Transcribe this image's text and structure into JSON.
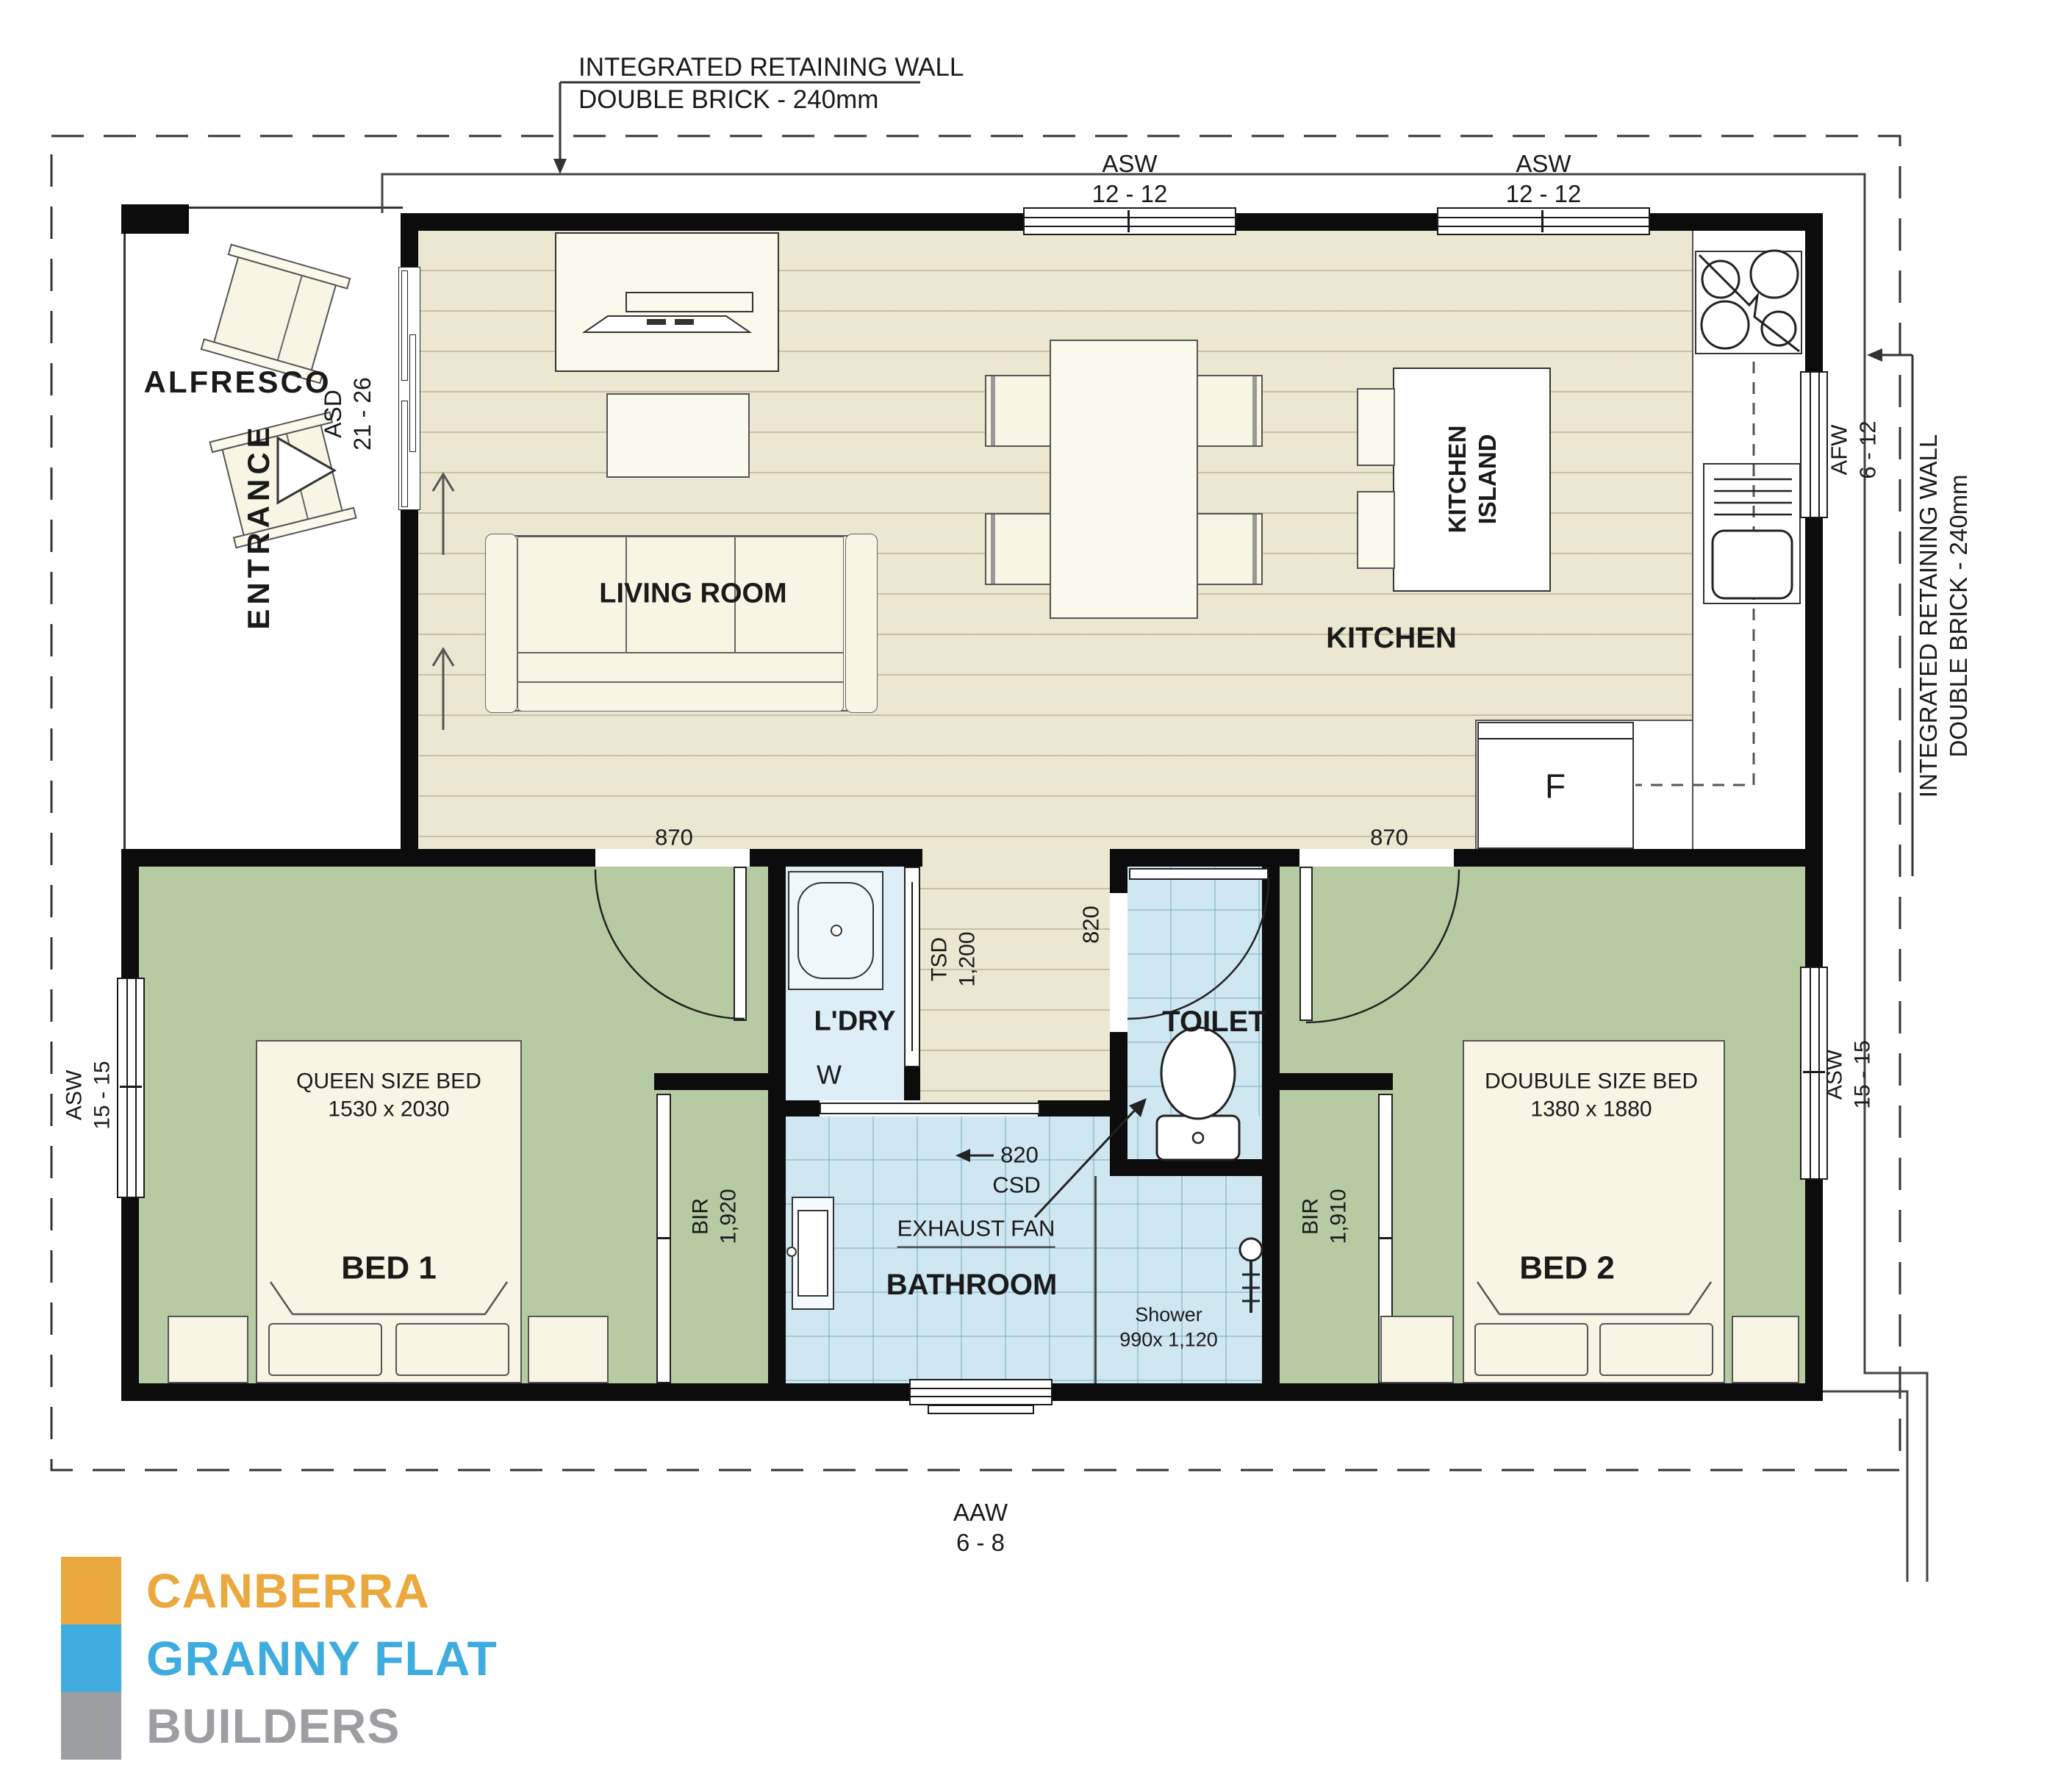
{
  "plan_title": "Granny flat floor plan",
  "annotations": {
    "retaining_top_line1": "INTEGRATED RETAINING WALL",
    "retaining_top_line2": "DOUBLE BRICK - 240mm",
    "retaining_right_line1": "INTEGRATED RETAINING WALL",
    "retaining_right_line2": "DOUBLE BRICK - 240mm"
  },
  "openings": {
    "asw_top1_code": "ASW",
    "asw_top1_size": "12 - 12",
    "asw_top2_code": "ASW",
    "asw_top2_size": "12 - 12",
    "afw_code": "AFW",
    "afw_size": "6 - 12",
    "asw_left_code": "ASW",
    "asw_left_size": "15 - 15",
    "asw_right_code": "ASW",
    "asw_right_size": "15 - 15",
    "aaw_code": "AAW",
    "aaw_size": "6 - 8",
    "asd_code": "ASD",
    "asd_size": "21 - 26",
    "tsd_code": "TSD",
    "tsd_size": "1,200",
    "door_bed1": "870",
    "door_bed2": "870",
    "door_toilet": "820",
    "csd_size": "820",
    "csd_code": "CSD"
  },
  "rooms": {
    "alfresco": "ALFRESCO",
    "entrance": "ENTRANCE",
    "living": "LIVING ROOM",
    "kitchen": "KITCHEN",
    "island_line1": "KITCHEN",
    "island_line2": "ISLAND",
    "fridge": "F",
    "laundry": "L'DRY",
    "washer": "W",
    "toilet": "TOILET",
    "bathroom": "BATHROOM",
    "exhaust": "EXHAUST FAN",
    "shower_line1": "Shower",
    "shower_line2": "990x 1,120",
    "bir1_code": "BIR",
    "bir1_size": "1,920",
    "bir2_code": "BIR",
    "bir2_size": "1,910",
    "bed1_type": "QUEEN SIZE BED",
    "bed1_dims": "1530 x 2030",
    "bed1_name": "BED 1",
    "bed2_type": "DOUBULE SIZE BED",
    "bed2_dims": "1380 x 1880",
    "bed2_name": "BED 2"
  },
  "logo": {
    "line1": "CANBERRA",
    "line2": "GRANNY FLAT",
    "line3": "BUILDERS",
    "color1": "#eba93d",
    "color2": "#3face0",
    "color3": "#9c9ea1"
  },
  "colors": {
    "wall": "#0c0c0c",
    "floor_living": "#ece7d1",
    "floor_bedroom": "#b7cba3",
    "floor_wet": "#cfe7f0",
    "boundary_dash": "#333333"
  }
}
